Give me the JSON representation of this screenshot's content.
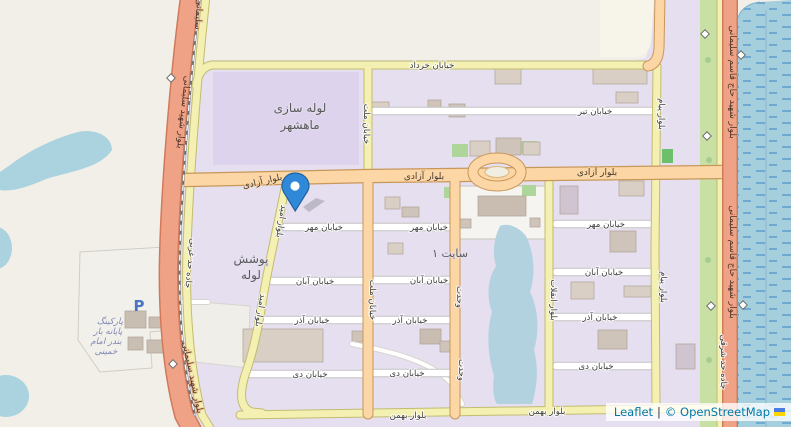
{
  "map": {
    "streets": {
      "khordad": "خیابان خرداد",
      "azadi": "بلوار آزادی",
      "tir": "خیابان تیر",
      "mehr": "خیابان مهر",
      "aban": "خیابان آبان",
      "azar": "خیابان آذر",
      "dey": "خیابان دی",
      "bahman": "بلوار بهمن",
      "mellat": "خیابان ملت",
      "vahdat": "وحدت",
      "enqelab": "بلوار انقلاب",
      "payam": "بلوار پیام",
      "omid": "بلوار امید",
      "soleimani": "بلوار شهید سلیمانی",
      "soleimani_short": "سلیمانی",
      "hadd_gharbi": "جاده حد غربی",
      "haj_qasem_soleimani": "بلوار شهید حاج قاسم سلیمانی",
      "hadd_sharqi": "جاده حد شرقی"
    },
    "areas": {
      "pipe_mill_line1": "لوله سازی",
      "pipe_mill_line2": "ماهشهر",
      "pipe_coating_line1": "پوشش",
      "pipe_coating_line2": "لوله",
      "site1": "سایت ۱",
      "parking_line1": "پارکینگ",
      "parking_line2": "پایانه بار",
      "parking_line3": "بندر امام",
      "parking_line4": "خمینی",
      "parking_symbol": "P"
    },
    "attribution": {
      "leaflet": "Leaflet",
      "separator": "|",
      "osm_copyright": "© OpenStreetMap"
    },
    "colors": {
      "background": "#f2efe9",
      "residential": "#e6dff0",
      "industrial_block": "#ddd3ec",
      "water": "#aad3df",
      "wetland": "#a5cfdd",
      "grass": "#c9e0a5",
      "trunk_road": "#f0a287",
      "primary_road": "#fcd6a4",
      "secondary_road": "#f3f0b1",
      "white_road": "#ffffff",
      "marker_blue": "#2f89d8",
      "link_blue": "#0078A8"
    }
  }
}
